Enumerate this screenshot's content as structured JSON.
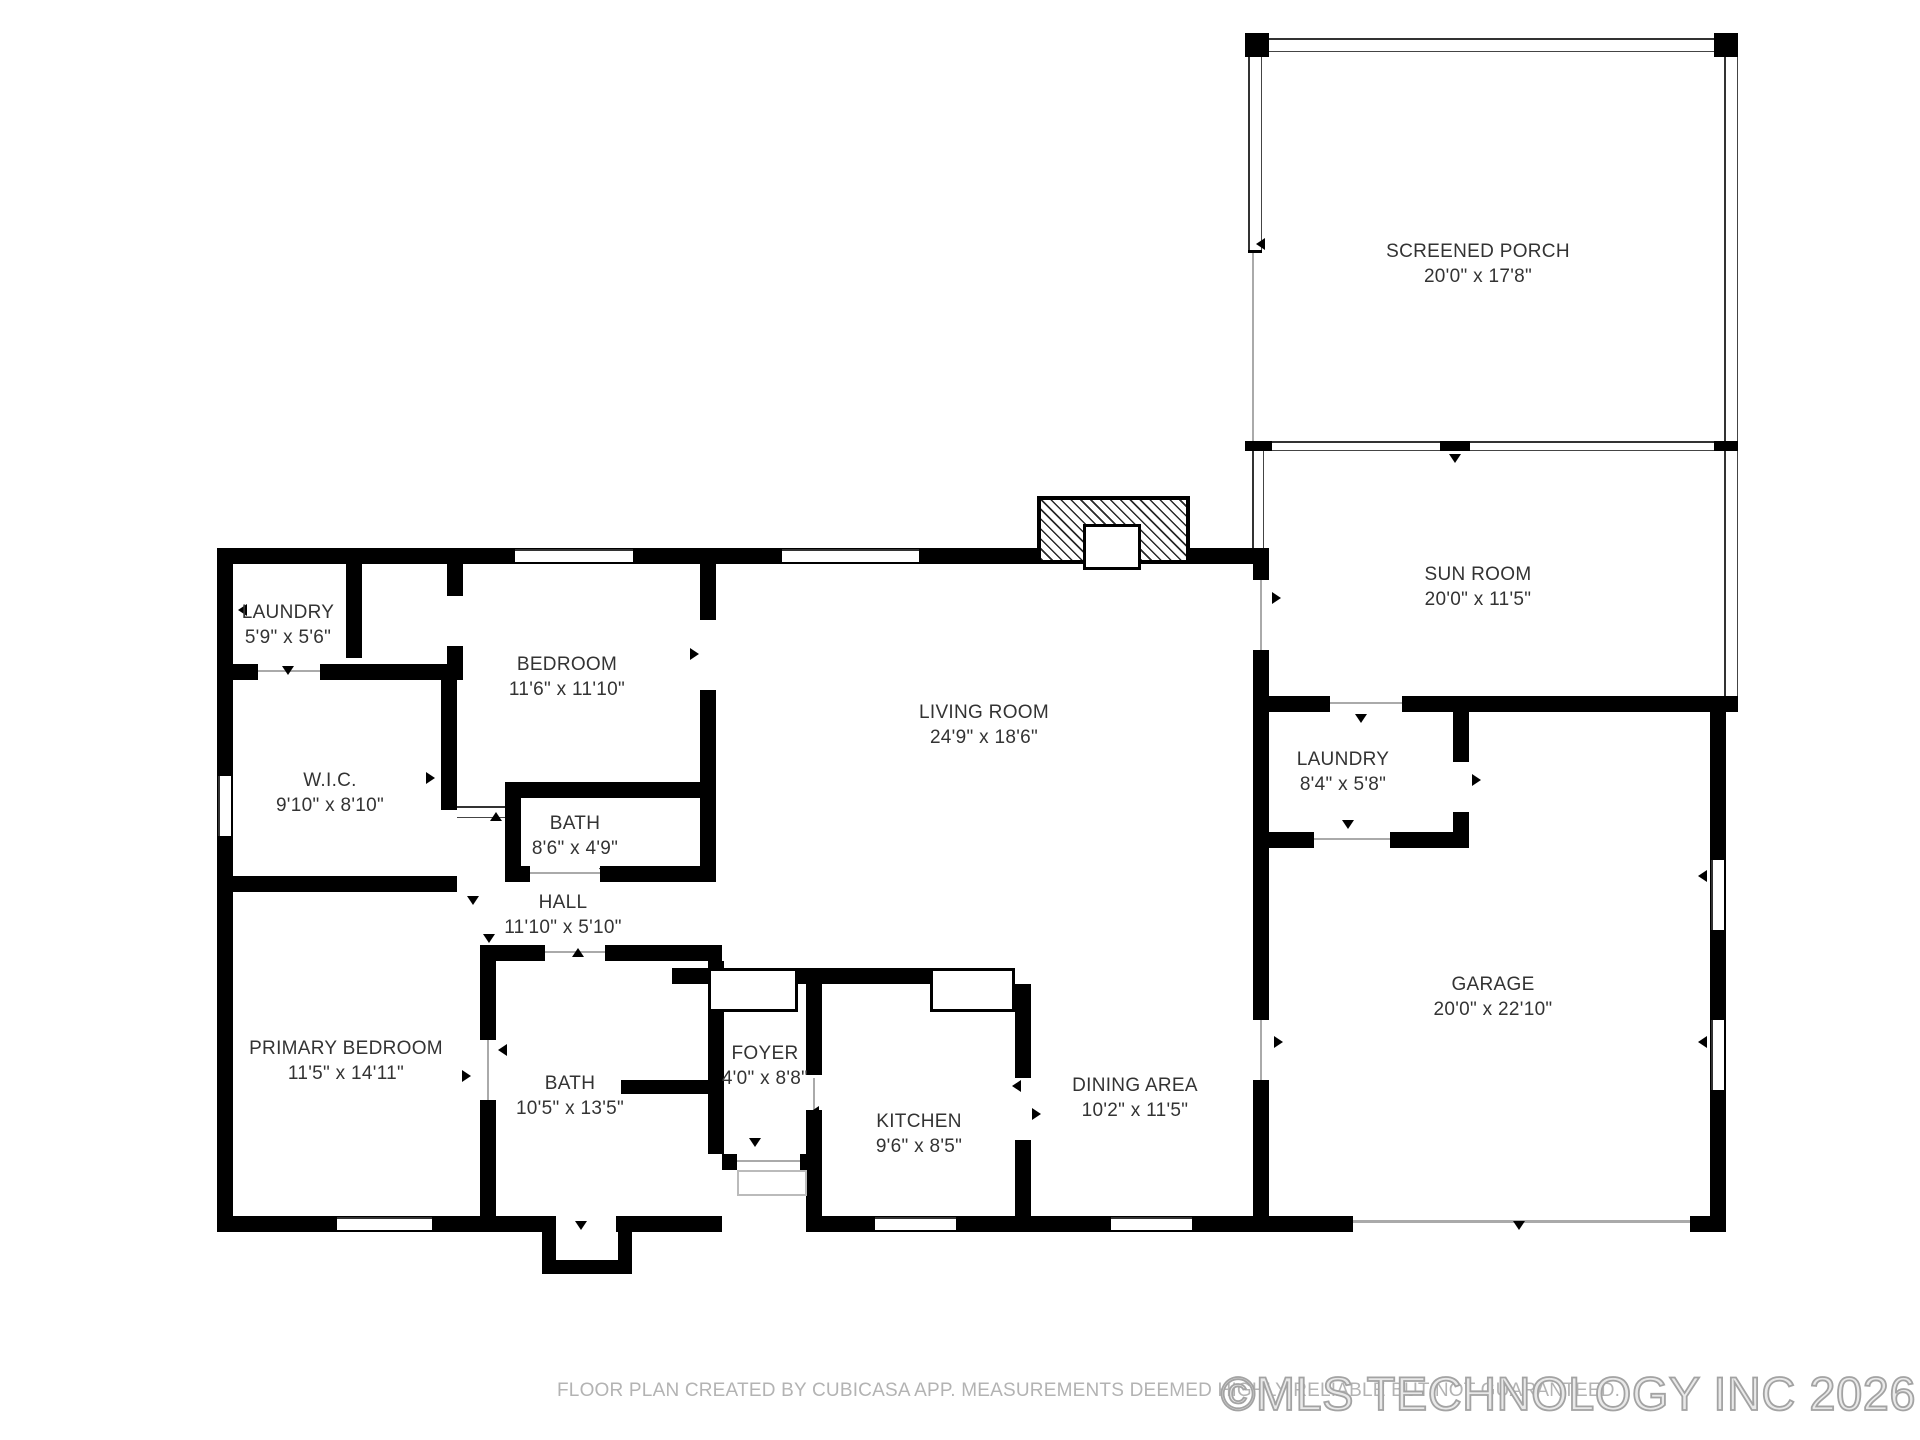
{
  "page": {
    "background": "#ffffff"
  },
  "rooms": [
    {
      "id": "screened-porch",
      "name": "SCREENED PORCH",
      "dims": "20'0\" x 17'8\"",
      "cx": 1478,
      "cy": 264
    },
    {
      "id": "sun-room",
      "name": "SUN ROOM",
      "dims": "20'0\" x 11'5\"",
      "cx": 1478,
      "cy": 587
    },
    {
      "id": "laundry-top",
      "name": "LAUNDRY",
      "dims": "5'9\" x 5'6\"",
      "cx": 288,
      "cy": 625
    },
    {
      "id": "bedroom",
      "name": "BEDROOM",
      "dims": "11'6\" x 11'10\"",
      "cx": 567,
      "cy": 677
    },
    {
      "id": "living-room",
      "name": "LIVING ROOM",
      "dims": "24'9\" x 18'6\"",
      "cx": 984,
      "cy": 725
    },
    {
      "id": "laundry-right",
      "name": "LAUNDRY",
      "dims": "8'4\" x 5'8\"",
      "cx": 1343,
      "cy": 772
    },
    {
      "id": "wic",
      "name": "W.I.C.",
      "dims": "9'10\" x 8'10\"",
      "cx": 330,
      "cy": 793
    },
    {
      "id": "bath-top",
      "name": "BATH",
      "dims": "8'6\" x 4'9\"",
      "cx": 575,
      "cy": 836
    },
    {
      "id": "hall",
      "name": "HALL",
      "dims": "11'10\" x 5'10\"",
      "cx": 563,
      "cy": 915
    },
    {
      "id": "garage",
      "name": "GARAGE",
      "dims": "20'0\" x 22'10\"",
      "cx": 1493,
      "cy": 997
    },
    {
      "id": "primary-bedroom",
      "name": "PRIMARY BEDROOM",
      "dims": "11'5\" x 14'11\"",
      "cx": 346,
      "cy": 1061
    },
    {
      "id": "bath-bottom",
      "name": "BATH",
      "dims": "10'5\" x 13'5\"",
      "cx": 570,
      "cy": 1096
    },
    {
      "id": "foyer",
      "name": "FOYER",
      "dims": "4'0\" x 8'8\"",
      "cx": 765,
      "cy": 1066
    },
    {
      "id": "kitchen",
      "name": "KITCHEN",
      "dims": "9'6\" x 8'5\"",
      "cx": 919,
      "cy": 1134
    },
    {
      "id": "dining-area",
      "name": "DINING AREA",
      "dims": "10'2\" x 11'5\"",
      "cx": 1135,
      "cy": 1098
    }
  ],
  "footer": {
    "disclaimer": "FLOOR PLAN CREATED BY CUBICASA APP. MEASUREMENTS DEEMED HIGHLY RELIABLE BUT NOT GUARANTEED.",
    "watermark": "©MLS TECHNOLOGY INC 2026"
  },
  "colors": {
    "wall": "#000000",
    "label": "#333333",
    "disclaimer": "#b3b3b3",
    "watermark_stroke": "#a3a3a3"
  }
}
